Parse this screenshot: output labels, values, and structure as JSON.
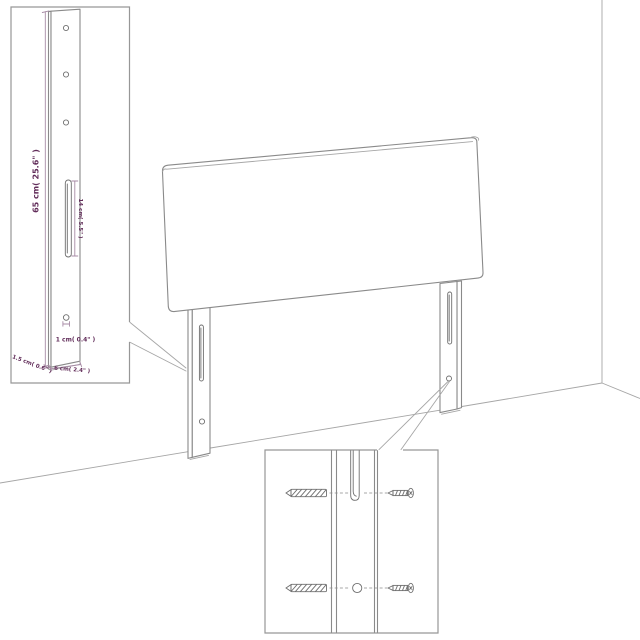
{
  "page": {
    "kind": "product dimension diagram",
    "subject": "upholstered headboard with two mounting legs in a room corner",
    "background": "#ffffff"
  },
  "colors": {
    "drawing_line": "#8a8a8a",
    "hardware_line": "#6f6f6f",
    "dimension_text": "#612c59",
    "dimension_line": "#a78ba5"
  },
  "leg_inset": {
    "height_label": "65 cm( 25.6\" )",
    "slot_label": "14 cm( 5.5\" )",
    "hole_label": "1 cm( 0.4\" )",
    "depth_label": "1.5 cm( 0.6\" )",
    "width_label": "6 cm( 2.4\" )"
  }
}
